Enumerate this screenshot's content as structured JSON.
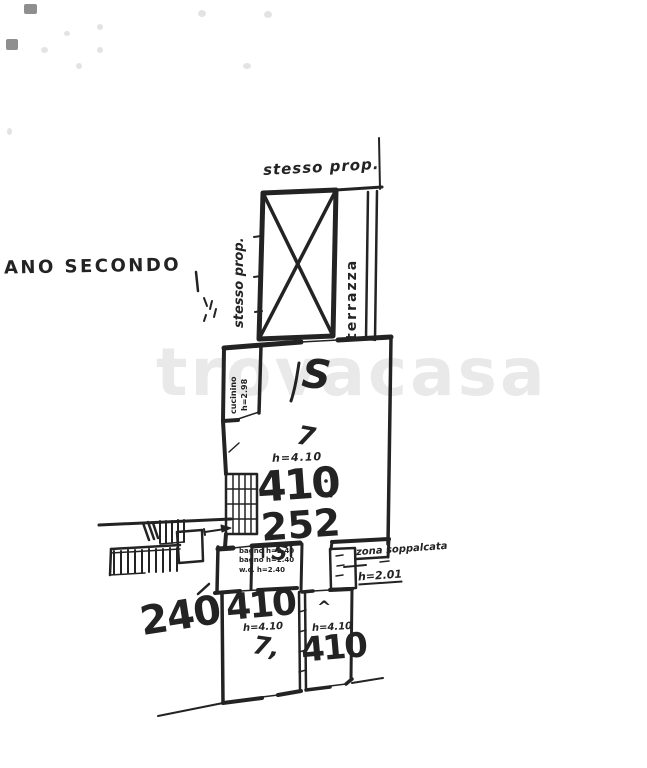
{
  "colors": {
    "paper": "#ffffff",
    "ink": "#232323",
    "watermark": "#e9e9e9"
  },
  "watermark": {
    "text": "trovacasa"
  },
  "plan": {
    "floor_label": "ANO SECONDO",
    "terrace": {
      "stesso_prop_top": "stesso prop.",
      "stesso_prop_side": "stesso prop.",
      "terrazza": "terrazza"
    },
    "kitchen": {
      "name": "cucinino",
      "height": "h=2.98"
    },
    "living": {
      "letter": "S",
      "mark": "7",
      "height": "h=4.10",
      "area": "410",
      "dim": "252"
    },
    "services": {
      "note1": "bagno h=2.40",
      "note2": "bagno h=2.40",
      "note3": "w.c. h=2.40",
      "digit": "5",
      "zone_label": "zona soppalcata",
      "zone_height": "h=2.01"
    },
    "bottom": {
      "dim": "240",
      "room_left": {
        "area": "410",
        "height": "h=4.10",
        "mark": "7,"
      },
      "room_right": {
        "mark": "^",
        "height": "h=4.10",
        "area": "410"
      }
    }
  }
}
